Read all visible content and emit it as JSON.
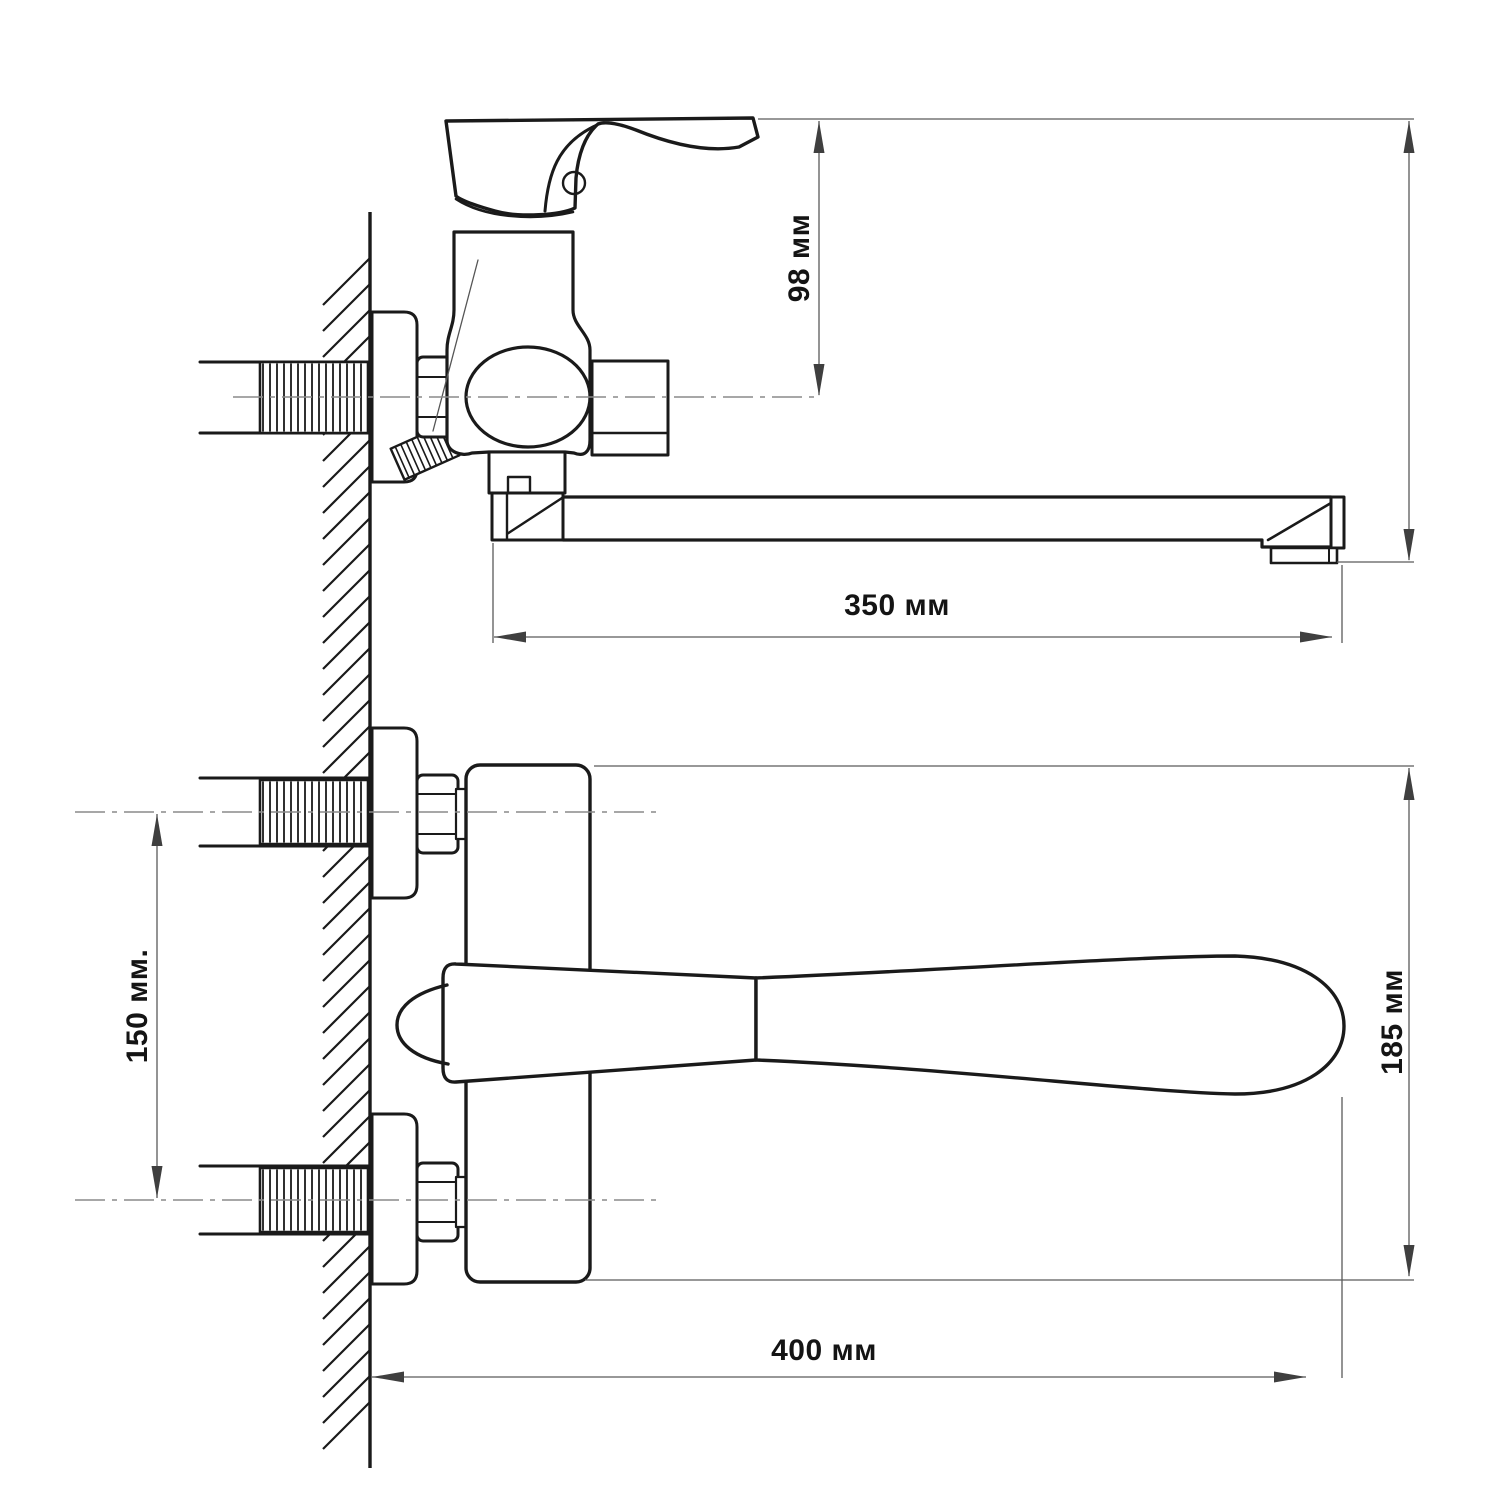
{
  "drawing": {
    "background": "#ffffff",
    "line_color": "#1a1a1a",
    "dimension_color": "#4f4f4f",
    "centerline_color": "#8a8a8a"
  },
  "dimensions": {
    "d98": {
      "label": "98 мм"
    },
    "d350": {
      "label": "350 мм"
    },
    "d150": {
      "label": "150 мм."
    },
    "d400": {
      "label": "400 мм"
    },
    "d185": {
      "label": "185 мм"
    }
  }
}
